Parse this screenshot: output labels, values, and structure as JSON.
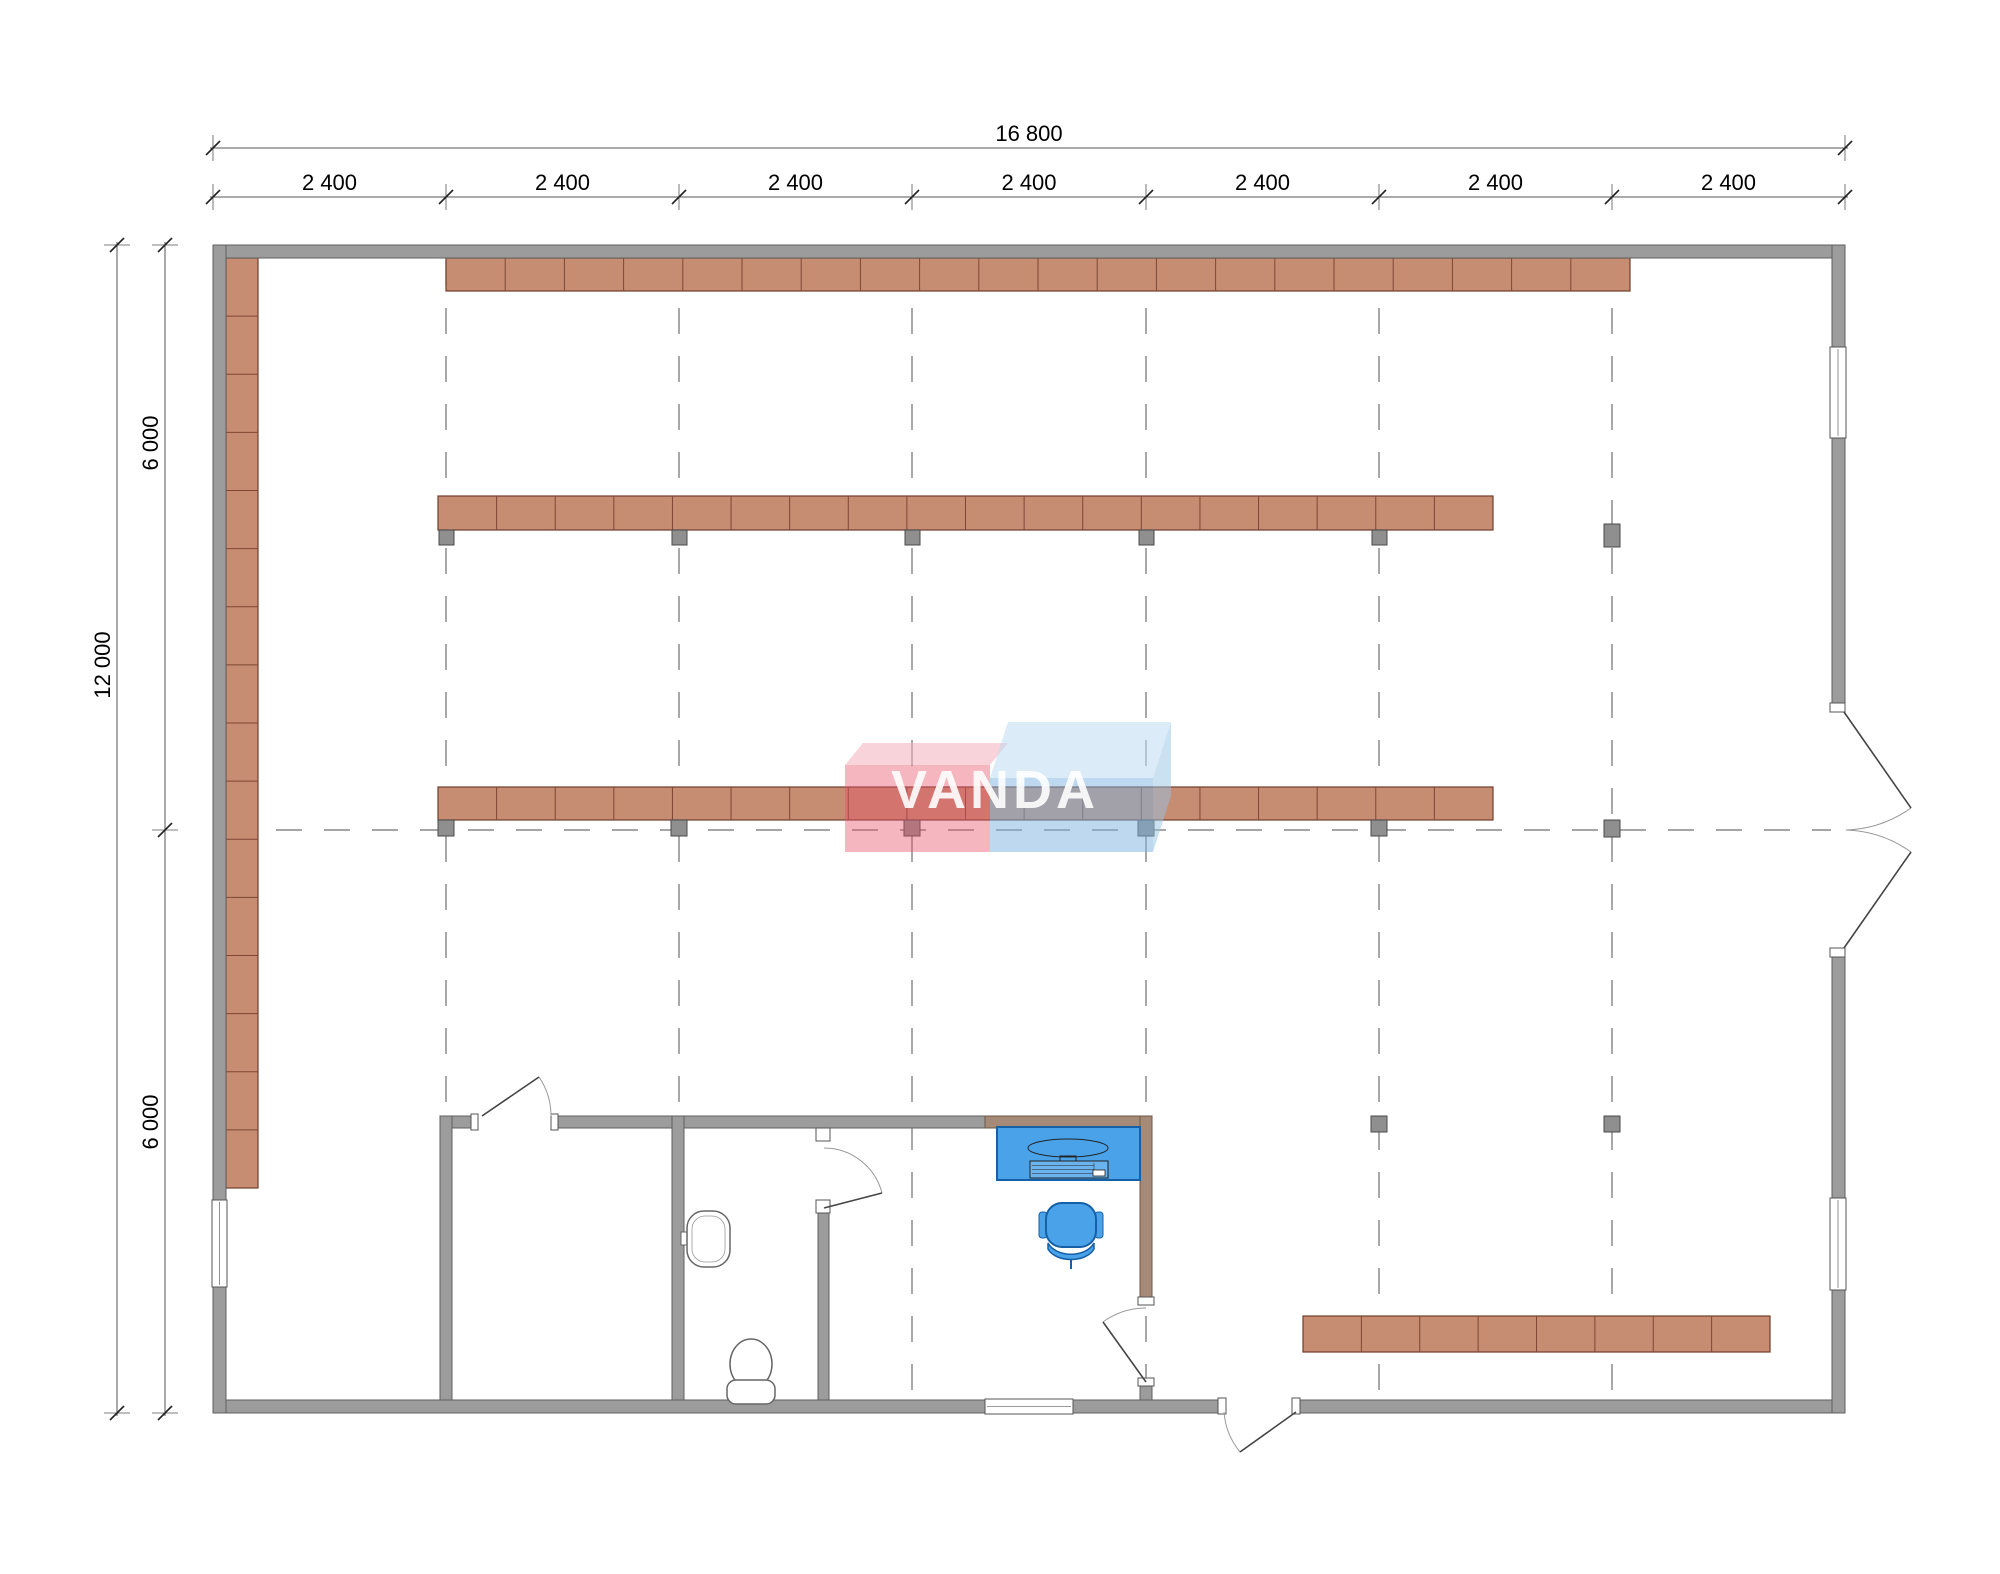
{
  "drawing": {
    "title": "retail floor plan",
    "watermark": {
      "text": "VANDA"
    },
    "dimensions": {
      "top_total": "16 800",
      "top_segments": [
        "2 400",
        "2 400",
        "2 400",
        "2 400",
        "2 400",
        "2 400",
        "2 400"
      ],
      "left_total": "12 000",
      "left_halves": [
        "6 000",
        "6 000"
      ]
    },
    "colors": {
      "wall": "#9c9c9c",
      "wall_stroke": "#5f5f5f",
      "tan_wall": "#a58b77",
      "tan_wall_stroke": "#6e5948",
      "shelf": "#c68d73",
      "shelf_stroke": "#6f3d2b",
      "shelf_divider": "#7d4733",
      "column": "#8f8f8f",
      "column_stroke": "#4a4a4a",
      "grid": "#6f6f6f",
      "dim_line": "#555555",
      "dim_tick": "#222222",
      "dim_text": "#000000",
      "fixture_stroke": "#666666",
      "desk": "#4aa3e8",
      "desk_stroke": "#1660a8",
      "door_leaf": "#444444",
      "door_arc": "#999999",
      "watermark_pink_front": "rgba(230,80,105,0.42)",
      "watermark_pink_top": "rgba(243,175,188,0.55)",
      "watermark_blue_front": "rgba(125,180,224,0.50)",
      "watermark_blue_top": "rgba(189,218,240,0.55)",
      "watermark_blue_side": "rgba(150,195,230,0.50)",
      "watermark_text": "#ffffff"
    },
    "geometry": {
      "canvas": {
        "w": 2000,
        "h": 1574
      },
      "grid": {
        "vertical_x": [
          446,
          679,
          912,
          1146,
          1379,
          1612
        ],
        "vertical_y1": 260,
        "vertical_y2": 1399,
        "horizontal_y": 830,
        "horizontal_x1": 228,
        "horizontal_x2": 1831,
        "dash": "26 22"
      },
      "walls_gray": [
        {
          "name": "outer-wall-top",
          "x": 213,
          "y": 245,
          "w": 1632,
          "h": 13
        },
        {
          "name": "outer-wall-bottom",
          "x": 213,
          "y": 1400,
          "w": 1632,
          "h": 13
        },
        {
          "name": "outer-wall-left",
          "x": 213,
          "y": 245,
          "w": 13,
          "h": 1168
        },
        {
          "name": "outer-wall-right",
          "x": 1832,
          "y": 245,
          "w": 13,
          "h": 1168
        },
        {
          "name": "partition-top-a",
          "x": 440,
          "y": 1116,
          "w": 38,
          "h": 12
        },
        {
          "name": "partition-top-b",
          "x": 551,
          "y": 1116,
          "w": 434,
          "h": 12
        },
        {
          "name": "room-a-left-wall",
          "x": 440,
          "y": 1116,
          "w": 12,
          "h": 284
        },
        {
          "name": "room-b-left-wall",
          "x": 672,
          "y": 1116,
          "w": 12,
          "h": 284
        },
        {
          "name": "room-b-right-wall",
          "x": 818,
          "y": 1213,
          "w": 11,
          "h": 187
        },
        {
          "name": "office-right-wall-stub",
          "x": 1140,
          "y": 1386,
          "w": 12,
          "h": 14
        }
      ],
      "walls_tan": [
        {
          "name": "office-top-wall",
          "x": 985,
          "y": 1116,
          "w": 167,
          "h": 12
        },
        {
          "name": "office-right-wall",
          "x": 1140,
          "y": 1116,
          "w": 12,
          "h": 181
        }
      ],
      "shelves": [
        {
          "name": "shelf-row-top",
          "x": 446,
          "y": 258,
          "w": 1184,
          "h": 33,
          "segments": 20,
          "dir": "h"
        },
        {
          "name": "shelf-row-second",
          "x": 438,
          "y": 496,
          "w": 1055,
          "h": 34,
          "segments": 18,
          "dir": "h"
        },
        {
          "name": "shelf-row-middle",
          "x": 438,
          "y": 787,
          "w": 1055,
          "h": 33,
          "segments": 18,
          "dir": "h"
        },
        {
          "name": "shelf-row-bottom-right",
          "x": 1303,
          "y": 1316,
          "w": 467,
          "h": 36,
          "segments": 8,
          "dir": "h"
        },
        {
          "name": "shelf-left-wall",
          "x": 226,
          "y": 258,
          "w": 32,
          "h": 930,
          "segments": 16,
          "dir": "v"
        }
      ],
      "columns": [
        {
          "x": 439,
          "y": 530,
          "w": 15,
          "h": 15
        },
        {
          "x": 672,
          "y": 530,
          "w": 15,
          "h": 15
        },
        {
          "x": 905,
          "y": 530,
          "w": 15,
          "h": 15
        },
        {
          "x": 1139,
          "y": 530,
          "w": 15,
          "h": 15
        },
        {
          "x": 1372,
          "y": 530,
          "w": 15,
          "h": 15
        },
        {
          "x": 1604,
          "y": 524,
          "w": 16,
          "h": 23
        },
        {
          "x": 438,
          "y": 820,
          "w": 16,
          "h": 16
        },
        {
          "x": 671,
          "y": 820,
          "w": 16,
          "h": 16
        },
        {
          "x": 904,
          "y": 820,
          "w": 16,
          "h": 16
        },
        {
          "x": 1138,
          "y": 820,
          "w": 16,
          "h": 16
        },
        {
          "x": 1371,
          "y": 820,
          "w": 16,
          "h": 16
        },
        {
          "x": 1604,
          "y": 820,
          "w": 16,
          "h": 17
        },
        {
          "x": 1371,
          "y": 1116,
          "w": 16,
          "h": 16
        },
        {
          "x": 1604,
          "y": 1116,
          "w": 16,
          "h": 16
        }
      ],
      "windows": [
        {
          "name": "window-right-top",
          "x": 1830,
          "y": 347,
          "w": 16,
          "h": 91,
          "dir": "v"
        },
        {
          "name": "window-right-bottom",
          "x": 1830,
          "y": 1198,
          "w": 16,
          "h": 92,
          "dir": "v"
        },
        {
          "name": "window-left",
          "x": 212,
          "y": 1200,
          "w": 15,
          "h": 87,
          "dir": "v"
        },
        {
          "name": "window-bottom",
          "x": 985,
          "y": 1399,
          "w": 88,
          "h": 15,
          "dir": "h"
        }
      ],
      "door_erase": [
        {
          "x": 1831,
          "y": 712,
          "w": 15,
          "h": 236
        },
        {
          "x": 1225,
          "y": 1399,
          "w": 68,
          "h": 15
        }
      ],
      "door_frames": [
        {
          "x": 1830,
          "y": 703,
          "w": 15,
          "h": 9
        },
        {
          "x": 1830,
          "y": 948,
          "w": 15,
          "h": 9
        },
        {
          "x": 471,
          "y": 1114,
          "w": 7,
          "h": 16
        },
        {
          "x": 551,
          "y": 1114,
          "w": 7,
          "h": 16
        },
        {
          "x": 816,
          "y": 1128,
          "w": 14,
          "h": 13
        },
        {
          "x": 816,
          "y": 1200,
          "w": 14,
          "h": 13
        },
        {
          "x": 1138,
          "y": 1297,
          "w": 16,
          "h": 8
        },
        {
          "x": 1138,
          "y": 1378,
          "w": 16,
          "h": 8
        },
        {
          "x": 1218,
          "y": 1398,
          "w": 8,
          "h": 16
        },
        {
          "x": 1292,
          "y": 1398,
          "w": 8,
          "h": 16
        }
      ],
      "door_leaves": [
        {
          "name": "double-door-upper-leaf",
          "x1": 1844,
          "y1": 712,
          "x2": 1911,
          "y2": 808
        },
        {
          "name": "double-door-lower-leaf",
          "x1": 1844,
          "y1": 948,
          "x2": 1911,
          "y2": 852
        },
        {
          "name": "room-a-door-leaf",
          "x1": 482,
          "y1": 1116,
          "x2": 539,
          "y2": 1077
        },
        {
          "name": "toilet-door-leaf",
          "x1": 824,
          "y1": 1208,
          "x2": 882,
          "y2": 1193
        },
        {
          "name": "office-door-leaf",
          "x1": 1146,
          "y1": 1382,
          "x2": 1103,
          "y2": 1322
        },
        {
          "name": "entrance-door-leaf",
          "x1": 1296,
          "y1": 1412,
          "x2": 1240,
          "y2": 1452
        }
      ],
      "door_arcs": [
        {
          "name": "double-door-upper-arc",
          "d": "M 1911 808 A 118 118 0 0 1 1846 830"
        },
        {
          "name": "double-door-lower-arc",
          "d": "M 1911 852 A 118 118 0 0 0 1846 830"
        },
        {
          "name": "room-a-door-arc",
          "d": "M 551 1116 A 69 69 0 0 0 539 1077"
        },
        {
          "name": "toilet-door-arc",
          "d": "M 824 1148 A 60 60 0 0 1 882 1193"
        },
        {
          "name": "office-door-arc",
          "d": "M 1103 1322 A 74 74 0 0 1 1146 1308"
        },
        {
          "name": "entrance-door-arc",
          "d": "M 1224 1412 A 72 72 0 0 0 1240 1452"
        }
      ],
      "desk": {
        "x": 997,
        "y": 1127,
        "w": 143,
        "h": 53
      },
      "monitor": {
        "cx": 1068,
        "cy": 1148,
        "rx": 40,
        "ry": 9,
        "stand_x": 1060,
        "stand_y": 1156,
        "stand_w": 16,
        "stand_h": 5
      },
      "keyboard": {
        "x": 1030,
        "y": 1161,
        "w": 78,
        "h": 17
      },
      "mouse": {
        "x": 1093,
        "y": 1170,
        "w": 12,
        "h": 6
      },
      "chair": {
        "seat": {
          "x": 1046,
          "y": 1203,
          "w": 50,
          "h": 44,
          "rx": 16
        },
        "arm_left": {
          "x": 1039,
          "y": 1212,
          "w": 8,
          "h": 26
        },
        "arm_right": {
          "x": 1095,
          "y": 1212,
          "w": 8,
          "h": 26
        },
        "base_d": "M 1048 1243 C 1056 1258 1086 1258 1094 1243 L 1094 1249 C 1086 1263 1056 1263 1048 1249 Z",
        "stem": {
          "x1": 1071,
          "y1": 1260,
          "x2": 1071,
          "y2": 1269
        }
      },
      "sink": {
        "x": 687,
        "y": 1211,
        "w": 43,
        "h": 56,
        "rx": 17,
        "inner": {
          "x": 692,
          "y": 1216,
          "w": 33,
          "h": 46,
          "rx": 13
        },
        "tap": {
          "x": 681,
          "y": 1232,
          "w": 10,
          "h": 13
        }
      },
      "toilet": {
        "bowl": {
          "cx": 751,
          "cy": 1364,
          "rx": 21,
          "ry": 25
        },
        "base": {
          "x": 727,
          "y": 1380,
          "w": 48,
          "h": 24,
          "rx": 9
        }
      },
      "watermark": {
        "pink_front": {
          "x": 845,
          "y": 765,
          "w": 145,
          "h": 87
        },
        "pink_top": "845,765 863,743 1008,743 990,765",
        "blue_front": {
          "x": 990,
          "y": 778,
          "w": 163,
          "h": 74
        },
        "blue_top": "990,778 1008,722 1171,722 1153,778",
        "blue_side": "1153,852 1153,778 1171,722 1171,796",
        "text_x": 995,
        "text_y": 808,
        "font_size": 54,
        "letter_spacing": 4
      },
      "dims": {
        "top_total_line_y": 148,
        "top_total_x1": 210,
        "top_total_x2": 1848,
        "top_total_ticks": [
          213,
          1845
        ],
        "top_total_label_x": 1029,
        "top_total_label_y": 141,
        "top_seg_line_y": 197,
        "top_seg_ticks": [
          213,
          446,
          679,
          912,
          1146,
          1379,
          1612,
          1845
        ],
        "top_seg_label_y": 190,
        "left_total_line_x": 117,
        "left_total_y1": 242,
        "left_total_y2": 1416,
        "left_total_ticks": [
          245,
          1413
        ],
        "left_total_label_x": 110,
        "left_total_label_y": 665,
        "left_seg_line_x": 165,
        "left_seg_ticks": [
          245,
          830,
          1413
        ],
        "left_seg_label_x": 158,
        "left_seg_label_ys": [
          443,
          1122
        ],
        "font_size": 22
      }
    }
  }
}
